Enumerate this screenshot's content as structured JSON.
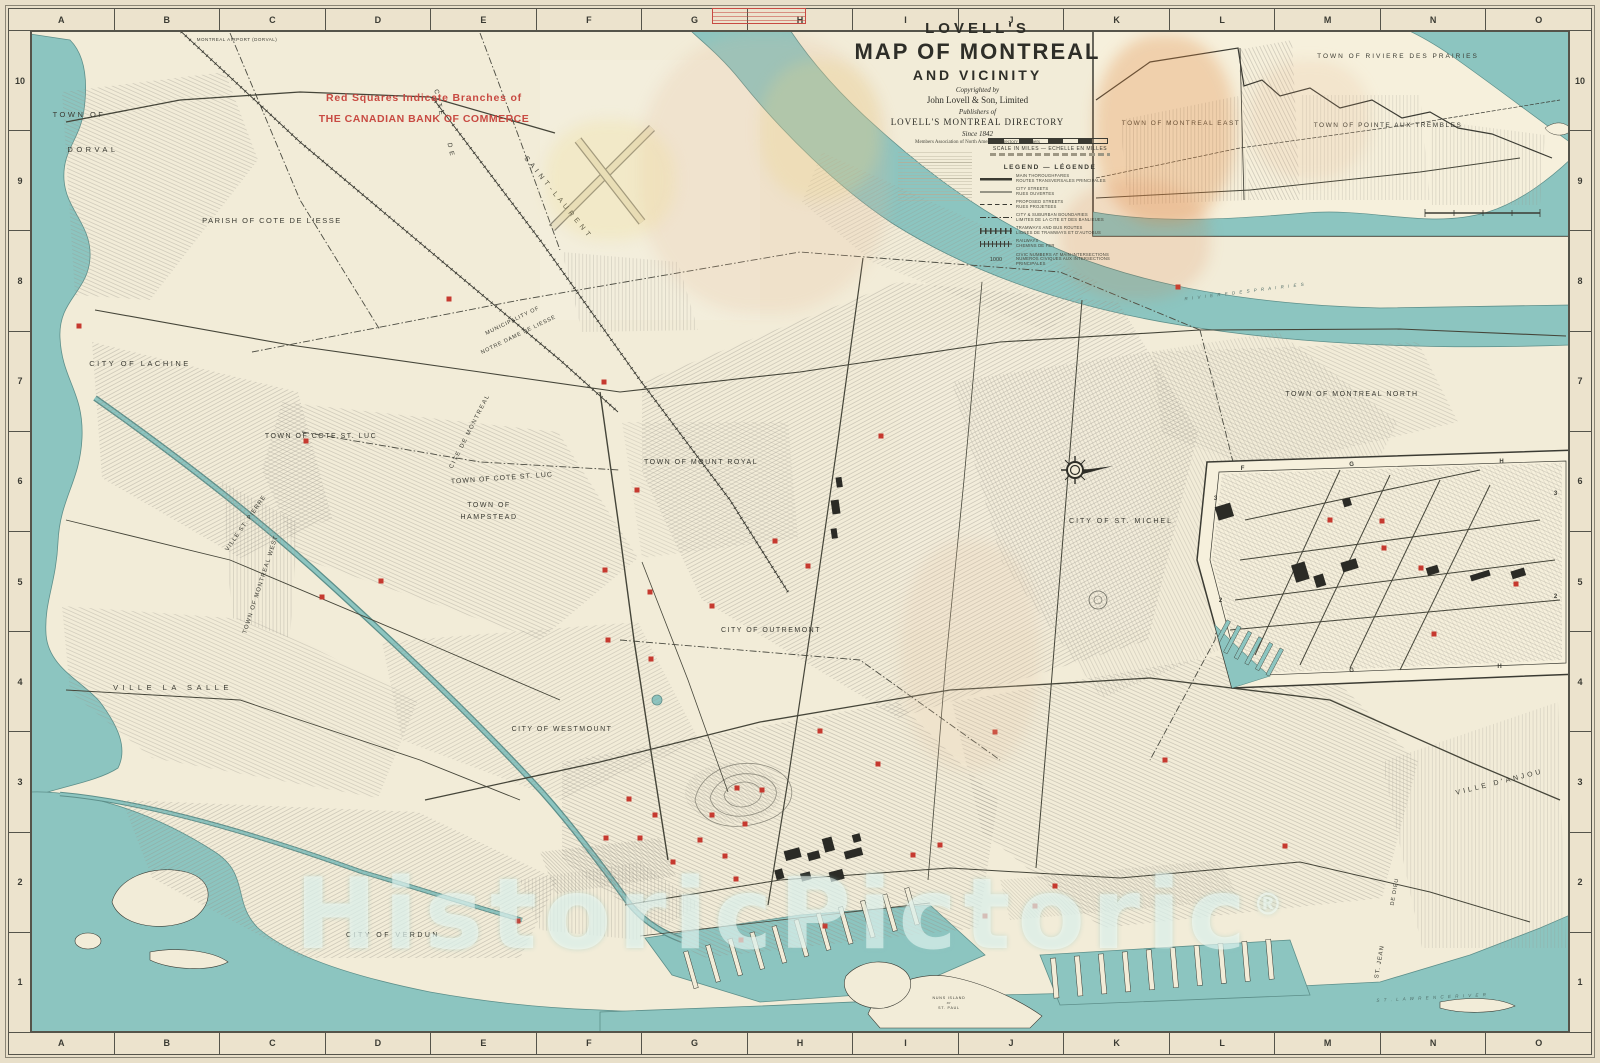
{
  "colors": {
    "paper": "#e8dfc9",
    "land": "#f2ecd8",
    "water": "#8cc5c0",
    "ink": "#3b3b33",
    "bank_red": "#c6392f",
    "note_red": "#c84a42"
  },
  "frame": {
    "letters": [
      "A",
      "B",
      "C",
      "D",
      "E",
      "F",
      "G",
      "H",
      "I",
      "J",
      "K",
      "L",
      "M",
      "N",
      "O"
    ],
    "numbers": [
      "10",
      "9",
      "8",
      "7",
      "6",
      "5",
      "4",
      "3",
      "2",
      "1"
    ]
  },
  "title": {
    "lovells": "LOVELL'S",
    "map_line": "MAP OF MONTREAL",
    "vicinity": "AND VICINITY",
    "copyrighted": "Copyrighted by",
    "publisher": "John Lovell & Son, Limited",
    "publishers_of": "Publishers of",
    "directory": "LOVELL'S MONTREAL DIRECTORY",
    "since": "Since 1842",
    "members": "Members Association of North American Directory Publishers"
  },
  "scale": {
    "label": "SCALE IN MILES — ECHELLE EN MILLES"
  },
  "legend": {
    "title": "LEGEND — LÉGENDE",
    "entries": [
      {
        "sym": "thick",
        "en": "MAIN THOROUGHFARES",
        "fr": "ROUTES TRANSVERSALES PRINCIPALES"
      },
      {
        "sym": "thin",
        "en": "CITY STREETS",
        "fr": "RUES OUVERTES"
      },
      {
        "sym": "dashed",
        "en": "PROPOSED STREETS",
        "fr": "RUES PROJETEES"
      },
      {
        "sym": "dashdot",
        "en": "CITY & SUBURBAN BOUNDARIES",
        "fr": "LIMITES DE LA CITE ET DES BANLIEUES"
      },
      {
        "sym": "tram",
        "en": "TRAMWAYS AND BUS ROUTES",
        "fr": "LIGNES DE TRAMWAYS ET D'AUTOBUS"
      },
      {
        "sym": "rail",
        "en": "RAILWAYS",
        "fr": "CHEMINS DE FER"
      },
      {
        "sym": "number",
        "sample": "1000",
        "en": "CIVIC NUMBERS AT MAIN INTERSECTIONS",
        "fr": "NUMEROS CIVIQUES AUX INTERSECTIONS PRINCIPALES"
      }
    ]
  },
  "watermark": {
    "text": "HistoricPictoric",
    "mark": "®"
  },
  "map_labels": [
    {
      "t": "MONTREAL AIRPORT (DORVAL)",
      "x": 237,
      "y": 41,
      "fs": 4.5,
      "ls": 0.5
    },
    {
      "t": "TOWN OF",
      "x": 79,
      "y": 117,
      "fs": 7.5,
      "ls": 2.5
    },
    {
      "t": "DORVAL",
      "x": 93,
      "y": 152,
      "fs": 7.5,
      "ls": 3.5
    },
    {
      "t": "PARISH OF COTE DE LIESSE",
      "x": 272,
      "y": 223,
      "fs": 7.5,
      "ls": 1.5
    },
    {
      "t": "C I T E",
      "x": 437,
      "y": 103,
      "fs": 6.5,
      "ls": 1,
      "rot": 78
    },
    {
      "t": "D E",
      "x": 449,
      "y": 150,
      "fs": 6.5,
      "ls": 1,
      "rot": 78
    },
    {
      "t": "S A I N T - L A U R E N T",
      "x": 556,
      "y": 198,
      "fs": 7,
      "ls": 1,
      "rot": 51
    },
    {
      "t": "MUNICIPALITY OF",
      "x": 513,
      "y": 322,
      "fs": 5.5,
      "ls": 0.8,
      "rot": -26
    },
    {
      "t": "NOTRE DAME DE LIESSE",
      "x": 519,
      "y": 336,
      "fs": 5.5,
      "ls": 0.8,
      "rot": -26
    },
    {
      "t": "CITY OF LACHINE",
      "x": 140,
      "y": 366,
      "fs": 7.5,
      "ls": 2.5
    },
    {
      "t": "TOWN OF COTE ST. LUC",
      "x": 321,
      "y": 438,
      "fs": 7,
      "ls": 1.5
    },
    {
      "t": "CITE DE MONTREAL",
      "x": 471,
      "y": 432,
      "fs": 6,
      "ls": 1.5,
      "rot": -63
    },
    {
      "t": "TOWN OF COTE ST. LUC",
      "x": 502,
      "y": 480,
      "fs": 7,
      "ls": 1,
      "rot": -4
    },
    {
      "t": "TOWN OF",
      "x": 489,
      "y": 507,
      "fs": 7,
      "ls": 1.5
    },
    {
      "t": "HAMPSTEAD",
      "x": 489,
      "y": 519,
      "fs": 7,
      "ls": 1.5
    },
    {
      "t": "TOWN OF MOUNT ROYAL",
      "x": 701,
      "y": 464,
      "fs": 7,
      "ls": 1.5
    },
    {
      "t": "CITY OF ST. MICHEL",
      "x": 1121,
      "y": 523,
      "fs": 7,
      "ls": 2
    },
    {
      "t": "TOWN OF MONTREAL NORTH",
      "x": 1352,
      "y": 396,
      "fs": 7,
      "ls": 1.5
    },
    {
      "t": "CITY OF OUTREMONT",
      "x": 771,
      "y": 632,
      "fs": 7,
      "ls": 1.5
    },
    {
      "t": "CITY OF WESTMOUNT",
      "x": 562,
      "y": 731,
      "fs": 7,
      "ls": 1.5
    },
    {
      "t": "VILLE ST. PIERRE",
      "x": 247,
      "y": 524,
      "fs": 6,
      "ls": 1,
      "rot": -55
    },
    {
      "t": "TOWN OF MONTREAL WEST",
      "x": 262,
      "y": 585,
      "fs": 6,
      "ls": 1,
      "rot": -72
    },
    {
      "t": "VILLE LA SALLE",
      "x": 173,
      "y": 690,
      "fs": 7.5,
      "ls": 4.5
    },
    {
      "t": "CITY OF VERDUN",
      "x": 393,
      "y": 937,
      "fs": 7,
      "ls": 2.5
    },
    {
      "t": "VILLE D'ANJOU",
      "x": 1500,
      "y": 784,
      "fs": 7,
      "ls": 3,
      "rot": -14
    },
    {
      "t": "DE DIEU",
      "x": 1396,
      "y": 892,
      "fs": 5.5,
      "ls": 0.8,
      "rot": -80
    },
    {
      "t": "ST. JEAN",
      "x": 1381,
      "y": 962,
      "fs": 6,
      "ls": 1,
      "rot": -80
    },
    {
      "t": "TOWN OF MONTREAL EAST",
      "x": 1580,
      "y": 889,
      "fs": 3.8,
      "ls": 0.4,
      "rot": -90
    },
    {
      "t": "R I V I E R E   D E S   P R A I R I E S",
      "x": 1245,
      "y": 293,
      "fs": 4.5,
      "ls": 1.5,
      "rot": -7,
      "it": 1,
      "col": "#55706b"
    },
    {
      "t": "S T .   L A W R E N C E   R I V E R",
      "x": 1432,
      "y": 999,
      "fs": 4.5,
      "ls": 1.5,
      "rot": -3,
      "it": 1,
      "col": "#4f6d68"
    },
    {
      "t": "NUNS ISLAND",
      "x": 949,
      "y": 999,
      "fs": 3.6
    },
    {
      "t": "or",
      "x": 949,
      "y": 1004,
      "fs": 3.4,
      "it": 1
    },
    {
      "t": "ST. PAUL",
      "x": 949,
      "y": 1009,
      "fs": 3.6
    },
    {
      "t": "Red Squares Indicate Branches of",
      "x": 424,
      "y": 101,
      "fs": 10.5,
      "b": 1,
      "col": "#c84a42"
    },
    {
      "t": "THE CANADIAN BANK OF COMMERCE",
      "x": 424,
      "y": 122,
      "fs": 10.5,
      "b": 1,
      "ls": 0.5,
      "col": "#c84a42"
    },
    {
      "t": "TOWN OF RIVIERE DES PRAIRIES",
      "x": 1398,
      "y": 58,
      "fs": 6.5,
      "ls": 2
    },
    {
      "t": "TOWN OF MONTREAL EAST",
      "x": 1181,
      "y": 125,
      "fs": 6.5,
      "ls": 1.5
    },
    {
      "t": "TOWN OF POINTE AUX TREMBLES",
      "x": 1388,
      "y": 127,
      "fs": 6.5,
      "ls": 1.5
    },
    {
      "t": "F",
      "x": 1243,
      "y": 470,
      "fs": 6,
      "b": 1
    },
    {
      "t": "G",
      "x": 1352,
      "y": 466,
      "fs": 6,
      "b": 1
    },
    {
      "t": "H",
      "x": 1502,
      "y": 463,
      "fs": 6,
      "b": 1
    },
    {
      "t": "3",
      "x": 1216,
      "y": 500,
      "fs": 6,
      "b": 1
    },
    {
      "t": "2",
      "x": 1221,
      "y": 602,
      "fs": 6,
      "b": 1
    },
    {
      "t": "3",
      "x": 1556,
      "y": 495,
      "fs": 6,
      "b": 1
    },
    {
      "t": "2",
      "x": 1556,
      "y": 598,
      "fs": 6,
      "b": 1
    },
    {
      "t": "G",
      "x": 1352,
      "y": 672,
      "fs": 6,
      "b": 1
    },
    {
      "t": "H",
      "x": 1500,
      "y": 668,
      "fs": 6,
      "b": 1
    }
  ],
  "bank_squares": [
    [
      79,
      326
    ],
    [
      449,
      299
    ],
    [
      604,
      382
    ],
    [
      306,
      441
    ],
    [
      381,
      581
    ],
    [
      322,
      597
    ],
    [
      637,
      490
    ],
    [
      775,
      541
    ],
    [
      881,
      436
    ],
    [
      605,
      570
    ],
    [
      650,
      592
    ],
    [
      712,
      606
    ],
    [
      651,
      659
    ],
    [
      608,
      640
    ],
    [
      820,
      731
    ],
    [
      995,
      732
    ],
    [
      940,
      845
    ],
    [
      913,
      855
    ],
    [
      1178,
      287
    ],
    [
      1165,
      760
    ],
    [
      1285,
      846
    ],
    [
      737,
      788
    ],
    [
      762,
      790
    ],
    [
      712,
      815
    ],
    [
      745,
      824
    ],
    [
      700,
      840
    ],
    [
      725,
      856
    ],
    [
      736,
      879
    ],
    [
      741,
      940
    ],
    [
      825,
      926
    ],
    [
      518,
      921
    ],
    [
      629,
      799
    ],
    [
      655,
      815
    ],
    [
      606,
      838
    ],
    [
      640,
      838
    ],
    [
      673,
      862
    ],
    [
      1035,
      906
    ],
    [
      1055,
      886
    ],
    [
      985,
      916
    ],
    [
      878,
      764
    ],
    [
      808,
      566
    ],
    [
      1330,
      520
    ],
    [
      1382,
      521
    ],
    [
      1384,
      548
    ],
    [
      1421,
      568
    ],
    [
      1516,
      584
    ],
    [
      1434,
      634
    ]
  ]
}
